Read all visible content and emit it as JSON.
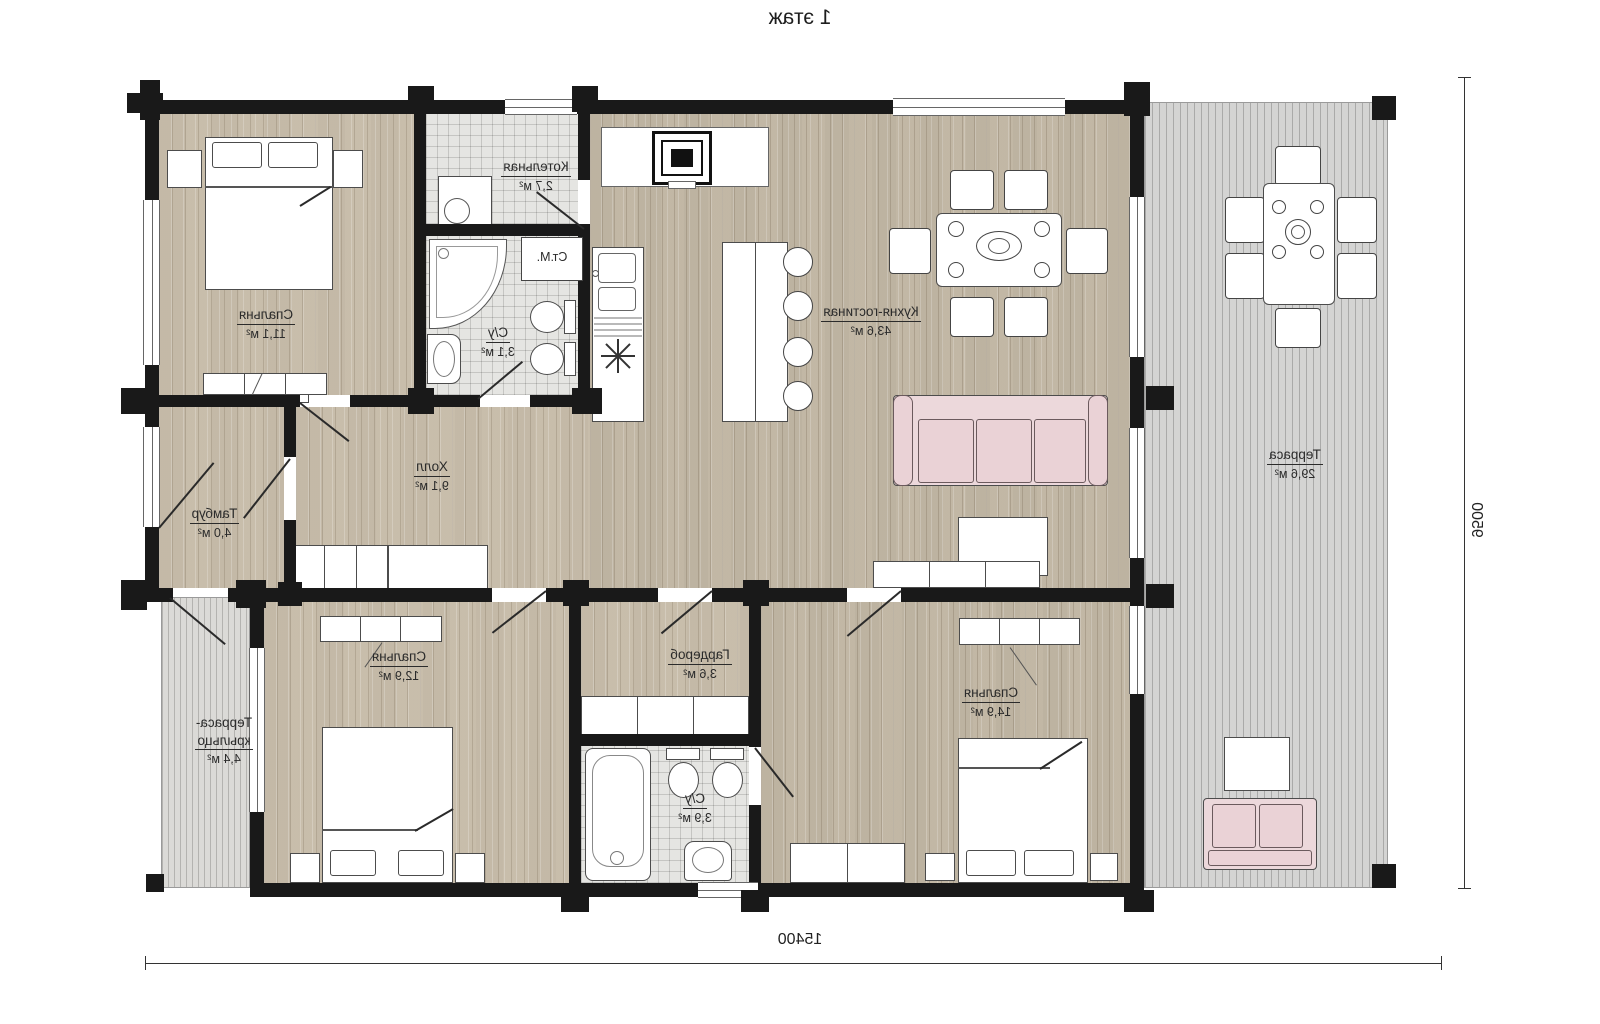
{
  "title": "1 этаж",
  "dimensions": {
    "bottom": "15400",
    "right": "9500"
  },
  "rooms": {
    "bedroom_top": {
      "name": "Спальня",
      "area": "11,1 м²"
    },
    "boiler": {
      "name": "Котельная",
      "area": "2,7 м²"
    },
    "bath_small": {
      "name": "С/у",
      "area": "3,1 м²"
    },
    "washer": {
      "label": "Ст.М."
    },
    "kitchen_living": {
      "name": "Кухня-гостиная",
      "area": "43,6 м²"
    },
    "terrace_right": {
      "name": "Терраса",
      "area": "29,6 м²"
    },
    "tambur": {
      "name": "Тамбур",
      "area": "4,0 м²"
    },
    "hall": {
      "name": "Холл",
      "area": "9,1 м²"
    },
    "bedroom_left": {
      "name": "Спальня",
      "area": "12,9 м²"
    },
    "gardrob": {
      "name": "Гардероб",
      "area": "3,6 м²"
    },
    "bath_big": {
      "name": "С/у",
      "area": "3,9 м²"
    },
    "bedroom_right": {
      "name": "Спальня",
      "area": "14,9 м²"
    },
    "porch": {
      "name_line1": "Терраса-",
      "name_line2": "крыльцо",
      "area": "4,4 м²"
    }
  }
}
